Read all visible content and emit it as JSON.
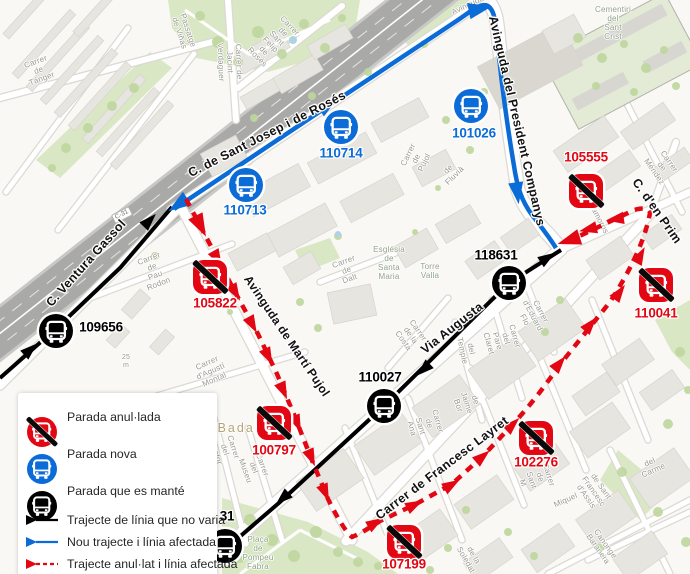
{
  "map": {
    "road_shield": "C-31",
    "colors": {
      "cancelled": "#e30613",
      "new": "#0b6bd7",
      "kept": "#000000"
    },
    "stops": [
      {
        "id": "110714",
        "status": "new",
        "x": 341,
        "y": 127,
        "lx": 341,
        "ly": 153
      },
      {
        "id": "110713",
        "status": "new",
        "x": 246,
        "y": 185,
        "lx": 245,
        "ly": 210
      },
      {
        "id": "101026",
        "status": "new",
        "x": 471,
        "y": 106,
        "lx": 474,
        "ly": 133
      },
      {
        "id": "118631",
        "status": "kept",
        "x": 509,
        "y": 283,
        "lx": 496,
        "ly": 255
      },
      {
        "id": "110027",
        "status": "kept",
        "x": 384,
        "y": 406,
        "lx": 380,
        "ly": 377
      },
      {
        "id": "109656",
        "status": "kept",
        "x": 56,
        "y": 331,
        "lx": 101,
        "ly": 327
      },
      {
        "id": "31",
        "status": "kept",
        "x": 225,
        "y": 546,
        "lx": 227,
        "ly": 516
      },
      {
        "id": "105555",
        "status": "cancelled",
        "x": 586,
        "y": 191,
        "lx": 586,
        "ly": 157
      },
      {
        "id": "105822",
        "status": "cancelled",
        "x": 210,
        "y": 277,
        "lx": 215,
        "ly": 303
      },
      {
        "id": "100797",
        "status": "cancelled",
        "x": 274,
        "y": 423,
        "lx": 274,
        "ly": 450
      },
      {
        "id": "107199",
        "status": "cancelled",
        "x": 404,
        "y": 542,
        "lx": 404,
        "ly": 564
      },
      {
        "id": "102276",
        "status": "cancelled",
        "x": 536,
        "y": 438,
        "lx": 536,
        "ly": 462
      },
      {
        "id": "110041",
        "status": "cancelled",
        "x": 656,
        "y": 285,
        "lx": 656,
        "ly": 313
      }
    ],
    "street_labels": [
      {
        "text": "C. de Sant Josep i de Rosés",
        "x": 267,
        "y": 134,
        "r": -27,
        "s": 12.5
      },
      {
        "text": "Avinguda del President Companys",
        "x": 517,
        "y": 121,
        "r": 77,
        "s": 12.5
      },
      {
        "text": "C. Ventura Gassol",
        "x": 86,
        "y": 263,
        "r": -48,
        "s": 12.5
      },
      {
        "text": "Avinguda de Martí Pujol",
        "x": 287,
        "y": 336,
        "r": 56,
        "s": 12
      },
      {
        "text": "Via Augusta",
        "x": 452,
        "y": 328,
        "r": -38,
        "s": 12.5
      },
      {
        "text": "Carrer de Francesc Layret",
        "x": 442,
        "y": 468,
        "r": -37,
        "s": 12.5
      },
      {
        "text": "C. d'en Prim",
        "x": 657,
        "y": 211,
        "r": 55,
        "s": 12.5
      }
    ],
    "minor_labels": [
      {
        "text": "Carrer de Tánger",
        "x": 39,
        "y": 71,
        "r": -20,
        "s": 8
      },
      {
        "text": "Passatge de Viñas",
        "x": 183,
        "y": 32,
        "r": 72,
        "s": 8
      },
      {
        "text": "Carrer de Jacint Verdaguer",
        "x": 229,
        "y": 62,
        "r": 88,
        "s": 8
      },
      {
        "text": "Carrer de Sant Felip de Rosés",
        "x": 273,
        "y": 42,
        "r": 46,
        "s": 8
      },
      {
        "text": "Cementiri del\nSant Crist",
        "x": 613,
        "y": 24,
        "r": 0,
        "s": 8,
        "c": "#93a18b"
      },
      {
        "text": "Carrer de Pujol",
        "x": 417,
        "y": 159,
        "r": -64,
        "s": 8
      },
      {
        "text": "de Fluvià",
        "x": 452,
        "y": 173,
        "r": -45,
        "s": 8
      },
      {
        "text": "Carrer de Dalt",
        "x": 347,
        "y": 271,
        "r": -20,
        "s": 8
      },
      {
        "text": "Església de\nSanta\nMaria",
        "x": 389,
        "y": 264,
        "r": 0,
        "s": 8,
        "c": "#93a18b"
      },
      {
        "text": "Torre Valla",
        "x": 430,
        "y": 272,
        "r": 0,
        "s": 8,
        "c": "#93a18b"
      },
      {
        "text": "Carrer de la Costa",
        "x": 410,
        "y": 336,
        "r": 55,
        "s": 8
      },
      {
        "text": "Carrer de Pau Rodon",
        "x": 154,
        "y": 272,
        "r": -21,
        "s": 8
      },
      {
        "text": "Carrer d'Agustí Montal",
        "x": 211,
        "y": 372,
        "r": -24,
        "s": 8
      },
      {
        "text": "Carrer del Rector",
        "x": 224,
        "y": 450,
        "r": 72,
        "s": 8
      },
      {
        "text": "Carrer del Museu",
        "x": 253,
        "y": 468,
        "r": 70,
        "s": 8
      },
      {
        "text": "del Temple",
        "x": 466,
        "y": 350,
        "r": 78,
        "s": 8
      },
      {
        "text": "Carrer del Pare Claret",
        "x": 501,
        "y": 340,
        "r": 74,
        "s": 8
      },
      {
        "text": "Carrer d'Eduard Flo",
        "x": 532,
        "y": 316,
        "r": 62,
        "s": 8
      },
      {
        "text": "Matamoros",
        "x": 596,
        "y": 215,
        "r": 62,
        "s": 8
      },
      {
        "text": "Carrer de Méndez",
        "x": 661,
        "y": 167,
        "r": 55,
        "s": 8
      },
      {
        "text": "de Jaime Bor",
        "x": 466,
        "y": 403,
        "r": 72,
        "s": 8
      },
      {
        "text": "Carrer de Sant Ana",
        "x": 424,
        "y": 425,
        "r": 74,
        "s": 8
      },
      {
        "text": "Carrer de Sant M",
        "x": 535,
        "y": 479,
        "r": 72,
        "s": 8
      },
      {
        "text": "de la Soledat",
        "x": 469,
        "y": 558,
        "r": 60,
        "s": 8
      },
      {
        "text": "de Sant Francesc d'Assís",
        "x": 593,
        "y": 492,
        "r": 55,
        "s": 8
      },
      {
        "text": "Miquel",
        "x": 566,
        "y": 501,
        "r": -24,
        "s": 8
      },
      {
        "text": "del Carme",
        "x": 652,
        "y": 467,
        "r": -24,
        "s": 8
      },
      {
        "text": "Canonge Baranera",
        "x": 601,
        "y": 547,
        "r": 55,
        "s": 8
      },
      {
        "text": "Plaça\nde Pompeu\nFabra",
        "x": 258,
        "y": 554,
        "r": 0,
        "s": 8,
        "c": "#8fa383"
      },
      {
        "text": "Badalona",
        "x": 252,
        "y": 428,
        "r": 0,
        "s": 12.5,
        "c": "#b5a476",
        "ls": 2
      },
      {
        "text": "25 m",
        "x": 126,
        "y": 362,
        "r": 0,
        "s": 7
      },
      {
        "text": "Avinguda",
        "x": 468,
        "y": 6,
        "r": -25,
        "s": 8
      }
    ],
    "routes": [
      {
        "name": "unchanged",
        "color": "#000000",
        "width": 4,
        "dash": "",
        "as": 1.1,
        "d": "M 0,378 L 60,325 L 120,268 L 172,207 M 561,250 L 509,283 L 384,406 L 280,502 L 222,552",
        "arrows": [
          {
            "x": 30,
            "y": 350,
            "a": -42
          },
          {
            "x": 149,
            "y": 221,
            "a": -46
          },
          {
            "x": 547,
            "y": 258,
            "a": -33
          },
          {
            "x": 424,
            "y": 369,
            "a": 137
          },
          {
            "x": 283,
            "y": 498,
            "a": 138
          }
        ]
      },
      {
        "name": "new",
        "color": "#0b6bd7",
        "width": 4.5,
        "dash": "",
        "as": 1.1,
        "d": "M 174,209 C 240,164 380,72 458,20 C 470,12 481,2 488,6 C 495,11 495,22 497,36 C 500,70 506,118 514,166 C 517,186 521,200 532,215 C 543,229 551,240 556,248",
        "arrows": [
          {
            "x": 179,
            "y": 204,
            "a": 146,
            "s": 1.3
          },
          {
            "x": 327,
            "y": 107,
            "a": -34
          },
          {
            "x": 479,
            "y": 9,
            "a": -12,
            "s": 1.35
          },
          {
            "x": 517,
            "y": 192,
            "a": 82,
            "s": 1.25
          }
        ]
      },
      {
        "name": "cancelled",
        "color": "#e30613",
        "width": 4.5,
        "dash": "8 7",
        "as": 1.12,
        "d": "M 186,199 L 214,252 L 236,294 L 258,334 L 277,374 L 295,417 L 311,458 L 328,499 Q 344,531 352,537 Q 362,533 380,521 L 416,504 L 452,484 L 483,456 L 513,424 Q 537,398 558,367 L 610,302 Q 643,251 650,213 Q 649,206 634,210 L 567,242",
        "arrows": [
          {
            "x": 200,
            "y": 225,
            "a": 63,
            "s": 1.3
          },
          {
            "x": 217,
            "y": 258,
            "a": 61
          },
          {
            "x": 235,
            "y": 292,
            "a": 60
          },
          {
            "x": 252,
            "y": 324,
            "a": 62
          },
          {
            "x": 268,
            "y": 356,
            "a": 64
          },
          {
            "x": 283,
            "y": 390,
            "a": 66
          },
          {
            "x": 297,
            "y": 423,
            "a": 67
          },
          {
            "x": 311,
            "y": 457,
            "a": 67
          },
          {
            "x": 325,
            "y": 492,
            "a": 67
          },
          {
            "x": 375,
            "y": 523,
            "a": -31
          },
          {
            "x": 414,
            "y": 505,
            "a": -27
          },
          {
            "x": 451,
            "y": 485,
            "a": -31
          },
          {
            "x": 482,
            "y": 457,
            "a": -40
          },
          {
            "x": 512,
            "y": 425,
            "a": -44
          },
          {
            "x": 559,
            "y": 364,
            "a": -50
          },
          {
            "x": 590,
            "y": 325,
            "a": -50
          },
          {
            "x": 619,
            "y": 293,
            "a": -54
          },
          {
            "x": 640,
            "y": 256,
            "a": -62
          },
          {
            "x": 616,
            "y": 219,
            "a": 172
          },
          {
            "x": 589,
            "y": 229,
            "a": 167
          },
          {
            "x": 570,
            "y": 240,
            "a": 162,
            "s": 1.3
          }
        ]
      }
    ]
  },
  "legend": {
    "items": [
      {
        "type": "stop",
        "status": "cancelled",
        "label": "Parada anul·lada"
      },
      {
        "type": "stop",
        "status": "new",
        "label": "Parada nova"
      },
      {
        "type": "stop",
        "status": "kept",
        "label": "Parada que es manté"
      },
      {
        "type": "line",
        "status": "unchanged",
        "label": "Trajecte de línia que no varia"
      },
      {
        "type": "line",
        "status": "new",
        "label": "Nou trajecte i línia afectada"
      },
      {
        "type": "line",
        "status": "cancelled",
        "label": "Trajecte anul·lat i línia afectada"
      }
    ]
  }
}
